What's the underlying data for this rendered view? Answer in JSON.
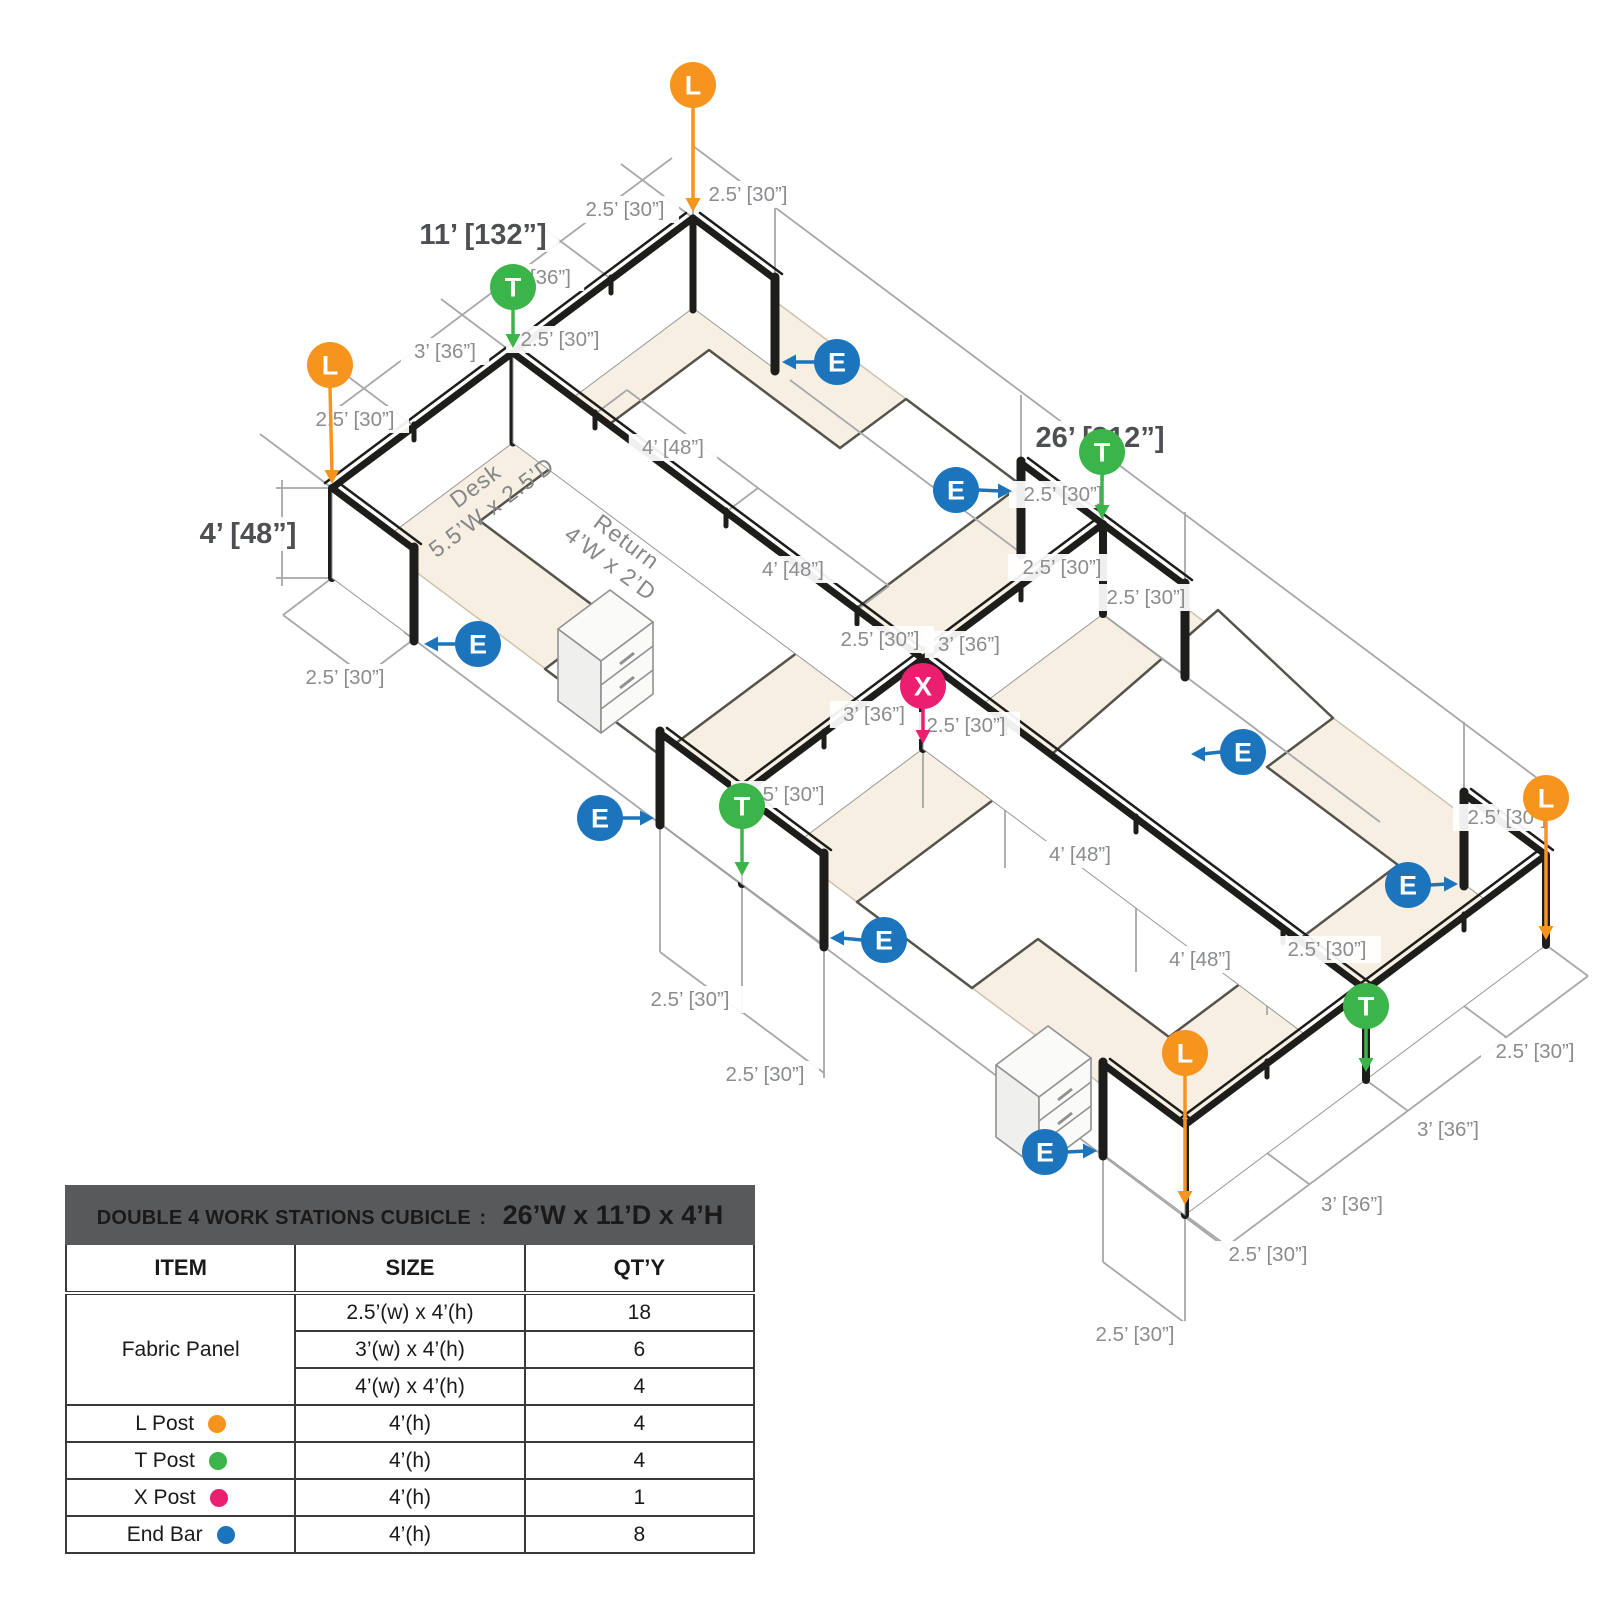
{
  "diagram": {
    "colors": {
      "orange": "#F7941E",
      "green": "#3BB54A",
      "pink": "#EC1E70",
      "blue": "#1C75BC",
      "cream": "#F7EFE2",
      "line_gray": "#A6A8AB",
      "label_gray": "#8A8C8F",
      "bold_gray": "#4D4F52",
      "wall_black": "#1D1D1B"
    },
    "bold_dims": [
      {
        "text": "11’ [132”]",
        "x": 483,
        "y": 235
      },
      {
        "text": "26’ [312”]",
        "x": 1100,
        "y": 438
      },
      {
        "text": "4’ [48”]",
        "x": 248,
        "y": 534
      }
    ],
    "dim_labels": [
      {
        "text": "2.5’ [30”]",
        "x": 625,
        "y": 210
      },
      {
        "text": "3’ [36”]",
        "x": 540,
        "y": 278
      },
      {
        "text": "3’ [36”]",
        "x": 445,
        "y": 352
      },
      {
        "text": "2.5’ [30”]",
        "x": 355,
        "y": 420
      },
      {
        "text": "2.5’ [30”]",
        "x": 560,
        "y": 340
      },
      {
        "text": "2.5’ [30”]",
        "x": 748,
        "y": 195
      },
      {
        "text": "2.5’ [30”]",
        "x": 345,
        "y": 678
      },
      {
        "text": "4’ [48”]",
        "x": 673,
        "y": 448
      },
      {
        "text": "4’ [48”]",
        "x": 793,
        "y": 570
      },
      {
        "text": "2.5’ [30”]",
        "x": 880,
        "y": 640
      },
      {
        "text": "2.5’ [30”]",
        "x": 1063,
        "y": 495
      },
      {
        "text": "2.5’ [30”]",
        "x": 1062,
        "y": 568
      },
      {
        "text": "2.5’ [30”]",
        "x": 1146,
        "y": 598
      },
      {
        "text": "3’ [36”]",
        "x": 969,
        "y": 645
      },
      {
        "text": "3’ [36”]",
        "x": 874,
        "y": 715
      },
      {
        "text": "2.5’ [30”]",
        "x": 966,
        "y": 726
      },
      {
        "text": "2.5’ [30”]",
        "x": 785,
        "y": 795
      },
      {
        "text": "4’ [48”]",
        "x": 1080,
        "y": 855
      },
      {
        "text": "4’ [48”]",
        "x": 1200,
        "y": 960
      },
      {
        "text": "2.5’ [30”]",
        "x": 1327,
        "y": 950
      },
      {
        "text": "2.5’ [30”]",
        "x": 1507,
        "y": 818
      },
      {
        "text": "2.5’ [30”]",
        "x": 690,
        "y": 1000
      },
      {
        "text": "2.5’ [30”]",
        "x": 765,
        "y": 1075
      },
      {
        "text": "2.5’ [30”]",
        "x": 1535,
        "y": 1052
      },
      {
        "text": "3’ [36”]",
        "x": 1448,
        "y": 1130
      },
      {
        "text": "3’ [36”]",
        "x": 1352,
        "y": 1205
      },
      {
        "text": "2.5’ [30”]",
        "x": 1268,
        "y": 1255
      },
      {
        "text": "2.5’ [30”]",
        "x": 1135,
        "y": 1335
      }
    ],
    "surface_labels": [
      {
        "lines": [
          "Desk",
          "5.5’W x 2.5’D"
        ],
        "x": 480,
        "y": 492,
        "rot": -36.8
      },
      {
        "lines": [
          "Return",
          "4’W x 2’D"
        ],
        "x": 622,
        "y": 548,
        "rot": 36.8
      }
    ],
    "posts": [
      {
        "label": "L",
        "color": "orange",
        "cx": 693,
        "cy": 85,
        "tx": 693,
        "ty": 212,
        "dir": "down"
      },
      {
        "label": "L",
        "color": "orange",
        "cx": 330,
        "cy": 365,
        "tx": 332,
        "ty": 484,
        "dir": "down"
      },
      {
        "label": "L",
        "color": "orange",
        "cx": 1546,
        "cy": 798,
        "tx": 1546,
        "ty": 940,
        "dir": "down"
      },
      {
        "label": "L",
        "color": "orange",
        "cx": 1185,
        "cy": 1053,
        "tx": 1185,
        "ty": 1205,
        "dir": "down"
      },
      {
        "label": "T",
        "color": "green",
        "cx": 513,
        "cy": 287,
        "tx": 513,
        "ty": 348,
        "dir": "down"
      },
      {
        "label": "T",
        "color": "green",
        "cx": 1102,
        "cy": 452,
        "tx": 1102,
        "ty": 519,
        "dir": "down"
      },
      {
        "label": "T",
        "color": "green",
        "cx": 742,
        "cy": 806,
        "tx": 742,
        "ty": 876,
        "dir": "down"
      },
      {
        "label": "T",
        "color": "green",
        "cx": 1366,
        "cy": 1006,
        "tx": 1366,
        "ty": 1072,
        "dir": "down"
      },
      {
        "label": "X",
        "color": "pink",
        "cx": 923,
        "cy": 686,
        "tx": 923,
        "ty": 744,
        "dir": "down"
      },
      {
        "label": "E",
        "color": "blue",
        "cx": 837,
        "cy": 362,
        "tx": 782,
        "ty": 362,
        "dir": "left"
      },
      {
        "label": "E",
        "color": "blue",
        "cx": 478,
        "cy": 644,
        "tx": 424,
        "ty": 644,
        "dir": "left"
      },
      {
        "label": "E",
        "color": "blue",
        "cx": 1243,
        "cy": 752,
        "tx": 1191,
        "ty": 754,
        "dir": "left"
      },
      {
        "label": "E",
        "color": "blue",
        "cx": 884,
        "cy": 940,
        "tx": 830,
        "ty": 938,
        "dir": "left"
      },
      {
        "label": "E",
        "color": "blue",
        "cx": 956,
        "cy": 490,
        "tx": 1012,
        "ty": 491,
        "dir": "right"
      },
      {
        "label": "E",
        "color": "blue",
        "cx": 600,
        "cy": 818,
        "tx": 654,
        "ty": 818,
        "dir": "right"
      },
      {
        "label": "E",
        "color": "blue",
        "cx": 1408,
        "cy": 885,
        "tx": 1458,
        "ty": 884,
        "dir": "right"
      },
      {
        "label": "E",
        "color": "blue",
        "cx": 1045,
        "cy": 1152,
        "tx": 1097,
        "ty": 1151,
        "dir": "right"
      }
    ]
  },
  "table": {
    "header_left": "DOUBLE 4 WORK STATIONS  CUBICLE",
    "header_sep": ":",
    "header_right": "26’W x 11’D x 4’H",
    "columns": [
      "ITEM",
      "SIZE",
      "QT’Y"
    ],
    "fabric_item": "Fabric Panel",
    "fabric_rows": [
      {
        "size": "2.5’(w) x 4’(h)",
        "qty": "18"
      },
      {
        "size": "3’(w) x 4’(h)",
        "qty": "6"
      },
      {
        "size": "4’(w) x 4’(h)",
        "qty": "4"
      }
    ],
    "post_rows": [
      {
        "item": "L Post",
        "dot": "orange",
        "size": "4’(h)",
        "qty": "4"
      },
      {
        "item": "T Post",
        "dot": "green",
        "size": "4’(h)",
        "qty": "4"
      },
      {
        "item": "X Post",
        "dot": "pink",
        "size": "4’(h)",
        "qty": "1"
      },
      {
        "item": "End Bar",
        "dot": "blue",
        "size": "4’(h)",
        "qty": "8"
      }
    ]
  }
}
